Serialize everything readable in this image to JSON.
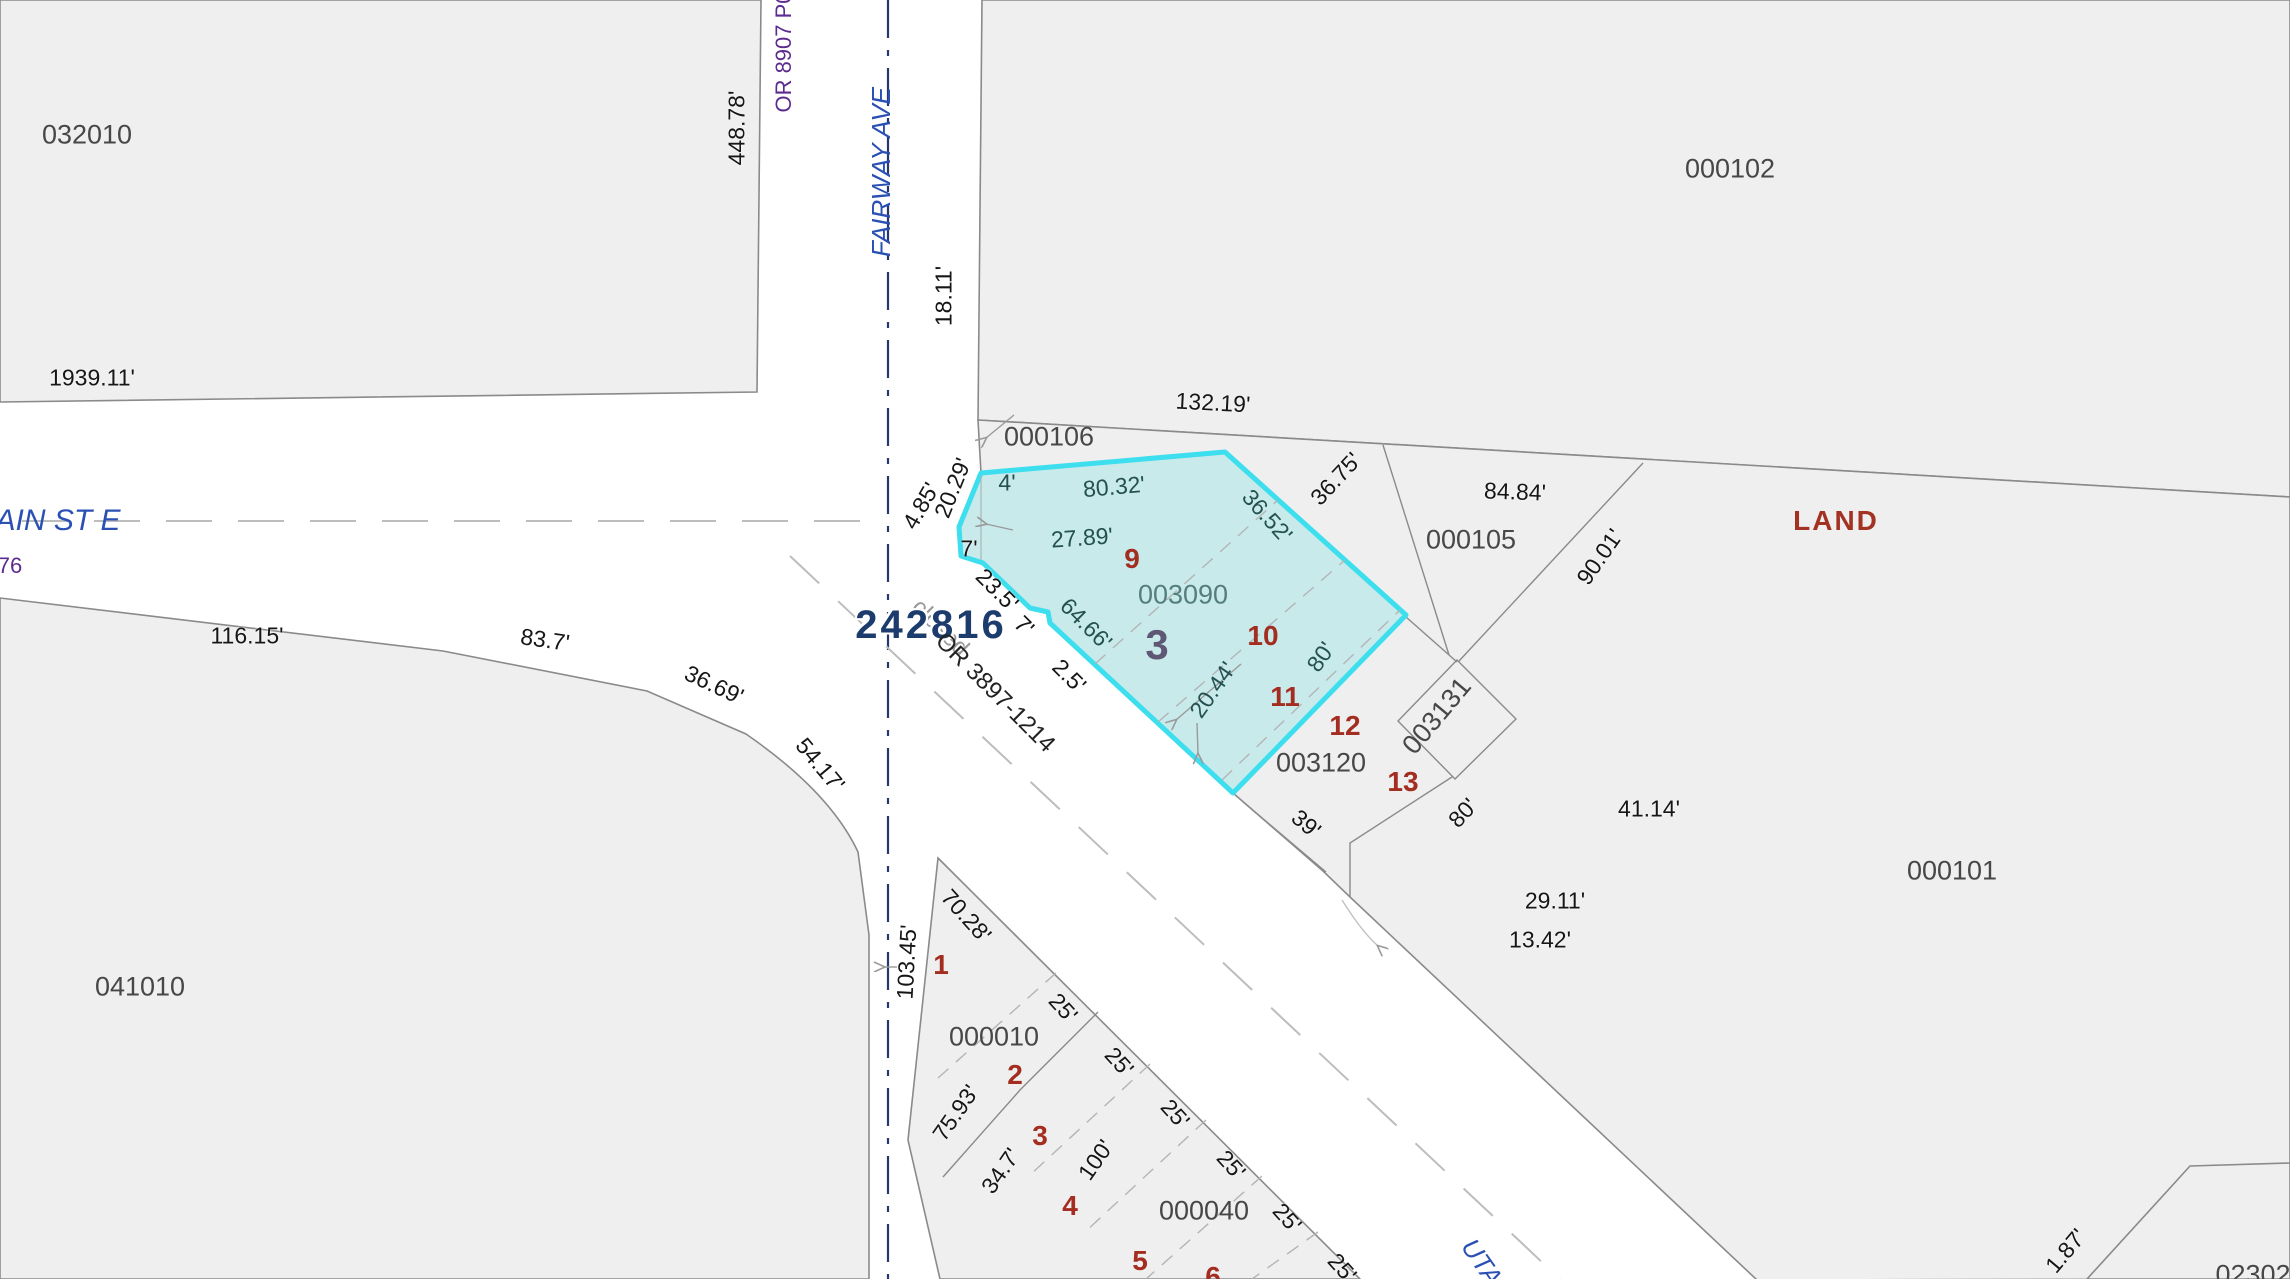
{
  "map": {
    "highlight": {
      "parcel_id": "003090",
      "account": "242816"
    },
    "colors": {
      "bg": "#ffffff",
      "parcelFill": "#efefef",
      "parcelLine": "#8a8a8a",
      "hlFill": "#c8eaeb",
      "hlStroke": "#3ddeed",
      "pid": "#474747",
      "pidHl": "#557d7d",
      "dim": "#161616",
      "dimHl": "#24514f",
      "lot": "#a32d20",
      "blk": "#5e5875",
      "sel": "#1c3c6e",
      "land": "#a33222",
      "street": "#2b50b4",
      "refPurple": "#5d2b90",
      "refGray": "#9a9a9a",
      "refBlack": "#222222",
      "clNavy": "#26366f",
      "clGray": "#bdbdbd",
      "dashGray": "#b4b4b4"
    },
    "labels": [
      {
        "t": "032010",
        "c": "pid",
        "x": 87,
        "y": 135
      },
      {
        "t": "000102",
        "c": "pid",
        "x": 1730,
        "y": 169
      },
      {
        "t": "1939.11'",
        "c": "dim",
        "x": 92,
        "y": 378
      },
      {
        "t": "448.78'",
        "c": "dim",
        "x": 737,
        "y": 128,
        "r": -90
      },
      {
        "t": "OR 8907 P0",
        "c": "refp",
        "x": 784,
        "y": 52,
        "r": -90
      },
      {
        "t": "FAIRWAY AVE",
        "c": "street",
        "x": 881,
        "y": 172,
        "r": -90,
        "n": "street-name-fairway-ave"
      },
      {
        "t": "18.11'",
        "c": "dim",
        "x": 944,
        "y": 296,
        "r": -90
      },
      {
        "t": "132.19'",
        "c": "dim",
        "x": 1213,
        "y": 403,
        "r": 3
      },
      {
        "t": "000106",
        "c": "pid",
        "x": 1049,
        "y": 437
      },
      {
        "t": "AIN ST E",
        "c": "street-lg",
        "x": 58,
        "y": 521,
        "n": "street-name-main-st-e"
      },
      {
        "t": "76",
        "c": "refp",
        "x": 10,
        "y": 566
      },
      {
        "t": "4.85'",
        "c": "dim",
        "x": 921,
        "y": 506,
        "r": -60
      },
      {
        "t": "20.29'",
        "c": "dim",
        "x": 953,
        "y": 488,
        "r": -68
      },
      {
        "t": "4'",
        "c": "dimh",
        "x": 1007,
        "y": 483
      },
      {
        "t": "80.32'",
        "c": "dimh",
        "x": 1114,
        "y": 487,
        "r": -5
      },
      {
        "t": "27.89'",
        "c": "dimh",
        "x": 1082,
        "y": 538,
        "r": -4
      },
      {
        "t": "36.52'",
        "c": "dimh",
        "x": 1267,
        "y": 516,
        "r": 48
      },
      {
        "t": "36.75'",
        "c": "dim",
        "x": 1336,
        "y": 479,
        "r": -47
      },
      {
        "t": "84.84'",
        "c": "dim",
        "x": 1515,
        "y": 492,
        "r": 2
      },
      {
        "t": "000105",
        "c": "pid",
        "x": 1471,
        "y": 540
      },
      {
        "t": "90.01'",
        "c": "dim",
        "x": 1600,
        "y": 557,
        "r": -55
      },
      {
        "t": "LAND",
        "c": "land",
        "x": 1836,
        "y": 521,
        "n": "land-note"
      },
      {
        "t": "9",
        "c": "lot",
        "x": 1132,
        "y": 559
      },
      {
        "t": "003090",
        "c": "pidh",
        "x": 1183,
        "y": 595,
        "n": "parcel-label-003090-selected"
      },
      {
        "t": "7'",
        "c": "dim",
        "x": 969,
        "y": 549
      },
      {
        "t": "23.5'",
        "c": "dim",
        "x": 997,
        "y": 590,
        "r": 45
      },
      {
        "t": "7'",
        "c": "dim",
        "x": 1024,
        "y": 626,
        "r": 45
      },
      {
        "t": "2.5'",
        "c": "dim",
        "x": 1069,
        "y": 676,
        "r": 45
      },
      {
        "t": "64.66'",
        "c": "dimh",
        "x": 1086,
        "y": 624,
        "r": 45
      },
      {
        "t": "3",
        "c": "blk",
        "x": 1157,
        "y": 645,
        "n": "block-number-3"
      },
      {
        "t": "10",
        "c": "lot",
        "x": 1263,
        "y": 636
      },
      {
        "t": "80'",
        "c": "dimh",
        "x": 1321,
        "y": 657,
        "r": -55
      },
      {
        "t": "20.44'",
        "c": "dimh",
        "x": 1213,
        "y": 690,
        "r": -55
      },
      {
        "t": "11",
        "c": "lot",
        "x": 1285,
        "y": 697
      },
      {
        "t": "closed",
        "c": "refg",
        "x": 940,
        "y": 628,
        "r": 45,
        "n": "status-note-closed"
      },
      {
        "t": "242816",
        "c": "sel",
        "x": 931,
        "y": 625,
        "n": "selected-parcel-account"
      },
      {
        "t": "OR 3897-1214",
        "c": "refk",
        "x": 995,
        "y": 693,
        "r": 45
      },
      {
        "t": "12",
        "c": "lot",
        "x": 1345,
        "y": 726
      },
      {
        "t": "003120",
        "c": "pid",
        "x": 1321,
        "y": 763
      },
      {
        "t": "003131",
        "c": "pid",
        "x": 1437,
        "y": 716,
        "r": -50
      },
      {
        "t": "13",
        "c": "lot",
        "x": 1403,
        "y": 782
      },
      {
        "t": "80'",
        "c": "dim",
        "x": 1463,
        "y": 813,
        "r": -47
      },
      {
        "t": "39'",
        "c": "dim",
        "x": 1306,
        "y": 824,
        "r": 40
      },
      {
        "t": "41.14'",
        "c": "dim",
        "x": 1649,
        "y": 809
      },
      {
        "t": "29.11'",
        "c": "dim",
        "x": 1555,
        "y": 901
      },
      {
        "t": "13.42'",
        "c": "dim",
        "x": 1540,
        "y": 940
      },
      {
        "t": "000101",
        "c": "pid",
        "x": 1952,
        "y": 871
      },
      {
        "t": "116.15'",
        "c": "dim",
        "x": 247,
        "y": 636
      },
      {
        "t": "83.7'",
        "c": "dim",
        "x": 545,
        "y": 640,
        "r": 8
      },
      {
        "t": "36.69'",
        "c": "dim",
        "x": 714,
        "y": 685,
        "r": 25
      },
      {
        "t": "54.17'",
        "c": "dim",
        "x": 820,
        "y": 765,
        "r": 50
      },
      {
        "t": "041010",
        "c": "pid",
        "x": 140,
        "y": 987
      },
      {
        "t": "103.45'",
        "c": "dim",
        "x": 907,
        "y": 962,
        "r": -87
      },
      {
        "t": "70.28'",
        "c": "dim",
        "x": 966,
        "y": 916,
        "r": 48
      },
      {
        "t": "1",
        "c": "lot",
        "x": 941,
        "y": 965
      },
      {
        "t": "000010",
        "c": "pid",
        "x": 994,
        "y": 1037
      },
      {
        "t": "25'",
        "c": "dim",
        "x": 1063,
        "y": 1008,
        "r": 48
      },
      {
        "t": "2",
        "c": "lot",
        "x": 1015,
        "y": 1075
      },
      {
        "t": "75.93'",
        "c": "dim",
        "x": 956,
        "y": 1113,
        "r": -55
      },
      {
        "t": "25'",
        "c": "dim",
        "x": 1119,
        "y": 1062,
        "r": 48
      },
      {
        "t": "3",
        "c": "lot",
        "x": 1040,
        "y": 1136
      },
      {
        "t": "34.7'",
        "c": "dim",
        "x": 1001,
        "y": 1171,
        "r": -55
      },
      {
        "t": "100'",
        "c": "dim",
        "x": 1096,
        "y": 1160,
        "r": -55
      },
      {
        "t": "25'",
        "c": "dim",
        "x": 1175,
        "y": 1114,
        "r": 48
      },
      {
        "t": "4",
        "c": "lot",
        "x": 1070,
        "y": 1206
      },
      {
        "t": "000040",
        "c": "pid",
        "x": 1204,
        "y": 1211
      },
      {
        "t": "25'",
        "c": "dim",
        "x": 1231,
        "y": 1165,
        "r": 48
      },
      {
        "t": "5",
        "c": "lot",
        "x": 1140,
        "y": 1261
      },
      {
        "t": "25'",
        "c": "dim",
        "x": 1287,
        "y": 1218,
        "r": 48
      },
      {
        "t": "6",
        "c": "lot",
        "x": 1213,
        "y": 1277
      },
      {
        "t": "25'",
        "c": "dim",
        "x": 1342,
        "y": 1268,
        "r": 48
      },
      {
        "t": "UTA",
        "c": "street",
        "x": 1482,
        "y": 1262,
        "r": 55,
        "n": "street-name-utah-ave"
      },
      {
        "t": "1.87'",
        "c": "dim",
        "x": 2066,
        "y": 1251,
        "r": -50
      },
      {
        "t": "02302",
        "c": "pid",
        "x": 2253,
        "y": 1275
      }
    ]
  }
}
